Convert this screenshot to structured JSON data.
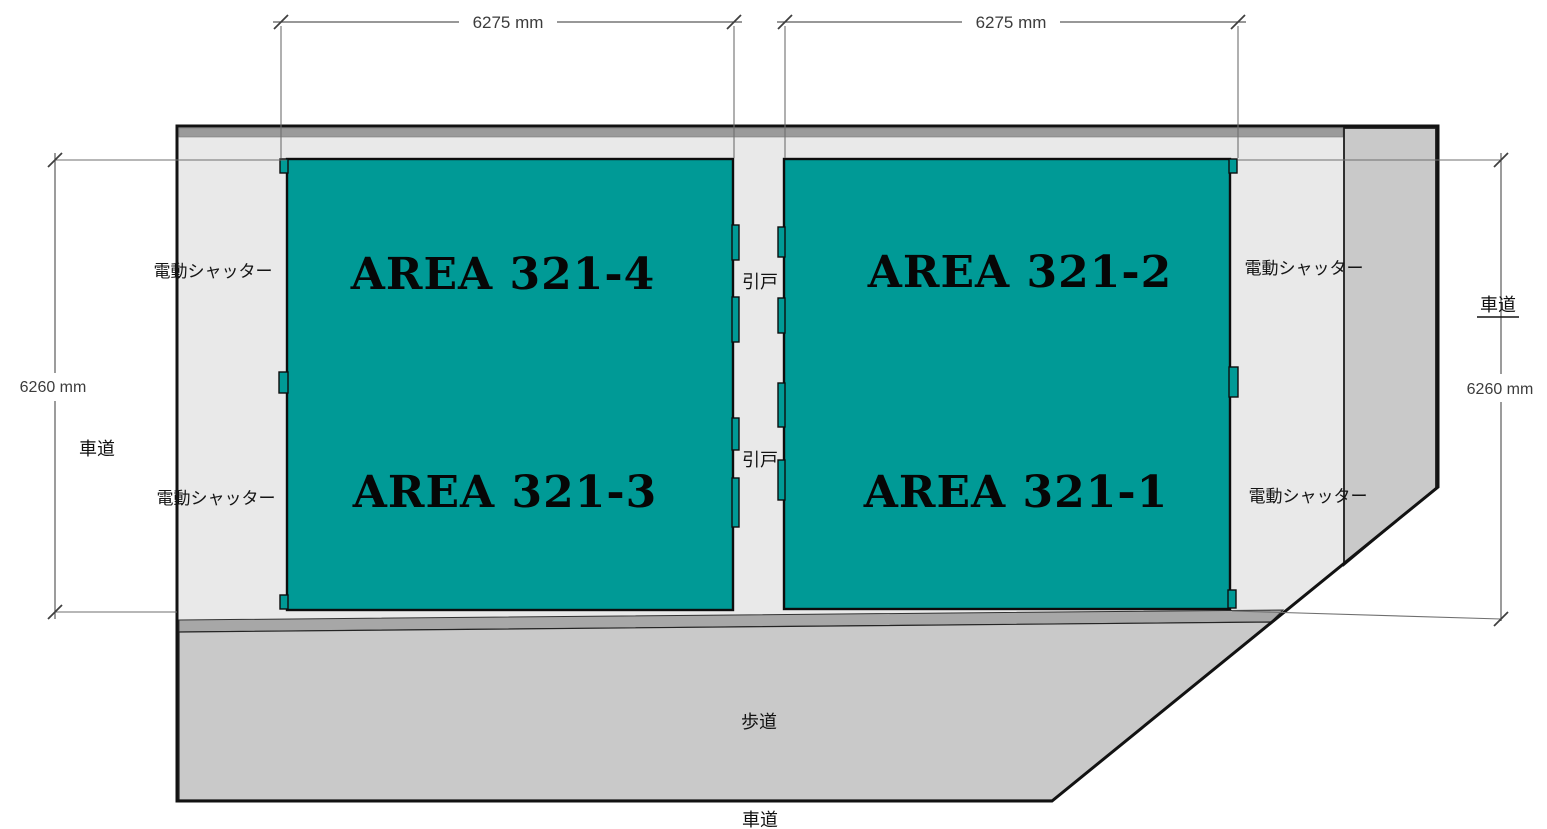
{
  "diagram": {
    "areas": {
      "west_top": "AREA 321-4",
      "west_bottom": "AREA 321-3",
      "east_top": "AREA 321-2",
      "east_bottom": "AREA 321-1"
    },
    "doors": {
      "upper": "引戸",
      "lower": "引戸"
    },
    "shutters": {
      "west_upper": "電動シャッター",
      "west_lower": "電動シャッター",
      "east_upper": "電動シャッター",
      "east_lower": "電動シャッター"
    },
    "surroundings": {
      "road_west": "車道",
      "road_east": "車道",
      "road_south": "車道",
      "sidewalk": "歩道"
    },
    "dimensions": {
      "width_west": "6275 mm",
      "width_east": "6275 mm",
      "height_west": "6260 mm",
      "height_east": "6260 mm"
    }
  },
  "colors": {
    "area_fill": "#009A96",
    "floor": "#E9E9E9",
    "band": "#9A9A9A",
    "pavement": "#C9C9C9",
    "curb": "#A7A7A7",
    "dim_line": "#5A5A5A"
  }
}
